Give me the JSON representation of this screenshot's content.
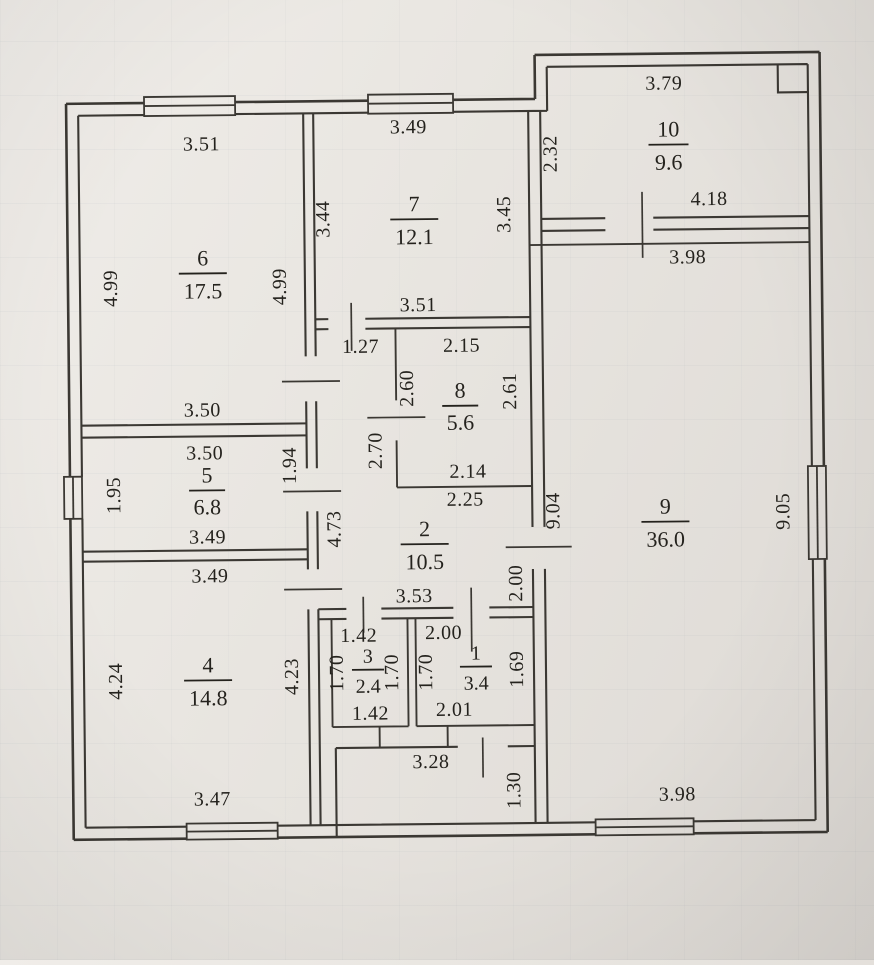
{
  "plan": {
    "rooms": {
      "r1": {
        "number": "1",
        "area": "3.4"
      },
      "r2": {
        "number": "2",
        "area": "10.5"
      },
      "r3": {
        "number": "3",
        "area": "2.4"
      },
      "r4": {
        "number": "4",
        "area": "14.8"
      },
      "r5": {
        "number": "5",
        "area": "6.8"
      },
      "r6": {
        "number": "6",
        "area": "17.5"
      },
      "r7": {
        "number": "7",
        "area": "12.1"
      },
      "r8": {
        "number": "8",
        "area": "5.6"
      },
      "r9": {
        "number": "9",
        "area": "36.0"
      },
      "r10": {
        "number": "10",
        "area": "9.6"
      }
    },
    "dims": {
      "r6_top": "3.51",
      "r6_left": "4.99",
      "r6_right": "4.99",
      "r6_bottom": "3.50",
      "r7_top": "3.49",
      "r7_left": "3.44",
      "r7_right": "3.45",
      "r7_bottom": "3.51",
      "r10_top": "3.79",
      "r10_left": "2.32",
      "r10_door": "4.18",
      "r9_top": "3.98",
      "r9_left": "9.04",
      "r9_right": "9.05",
      "r9_bottom": "3.98",
      "r8_top": "2.15",
      "r8_left": "2.60",
      "r8_right": "2.61",
      "r8_bottom": "2.14",
      "r2_top": "2.25",
      "r2_upper_left": "2.70",
      "r2_left": "4.73",
      "r2_right": "2.00",
      "r2_bottom": "3.53",
      "hall_door": "1.27",
      "r5_top": "3.50",
      "r5_left": "1.95",
      "r5_right": "1.94",
      "r5_bottom": "3.49",
      "r4_top": "3.49",
      "r4_left": "4.24",
      "r4_right": "4.23",
      "r4_bottom": "3.47",
      "r3_top": "1.42",
      "r3_left": "1.70",
      "r3_right": "1.70",
      "r3_bottom": "1.42",
      "r1_top": "2.00",
      "r1_left": "1.70",
      "r1_right": "1.69",
      "r1_bottom": "2.01",
      "porch_top": "3.28",
      "porch_right": "1.30"
    }
  }
}
